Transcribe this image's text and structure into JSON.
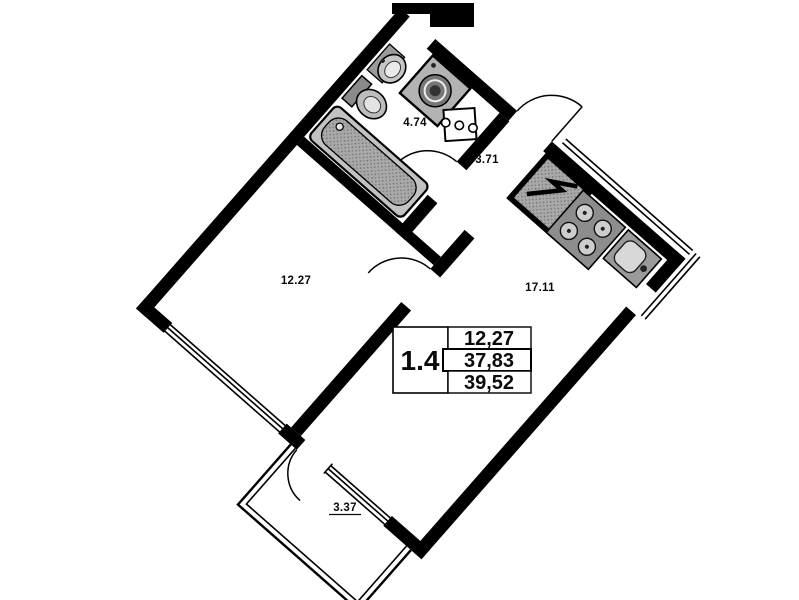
{
  "floorplan": {
    "unit_label": "1.4",
    "summary": {
      "living_area": "12,27",
      "apartment_area": "37,83",
      "total_area": "39,52"
    },
    "rooms": {
      "bathroom": {
        "area": "4.74"
      },
      "hallway": {
        "area": "3.71"
      },
      "bedroom": {
        "area": "12.27"
      },
      "kitchen_living": {
        "area": "17.11"
      },
      "balcony": {
        "area": "3.37"
      }
    },
    "colors": {
      "wall": "#000000",
      "fixture_gray": "#9a9a9a",
      "fixture_light": "#c9c9c9",
      "background": "#ffffff"
    }
  }
}
